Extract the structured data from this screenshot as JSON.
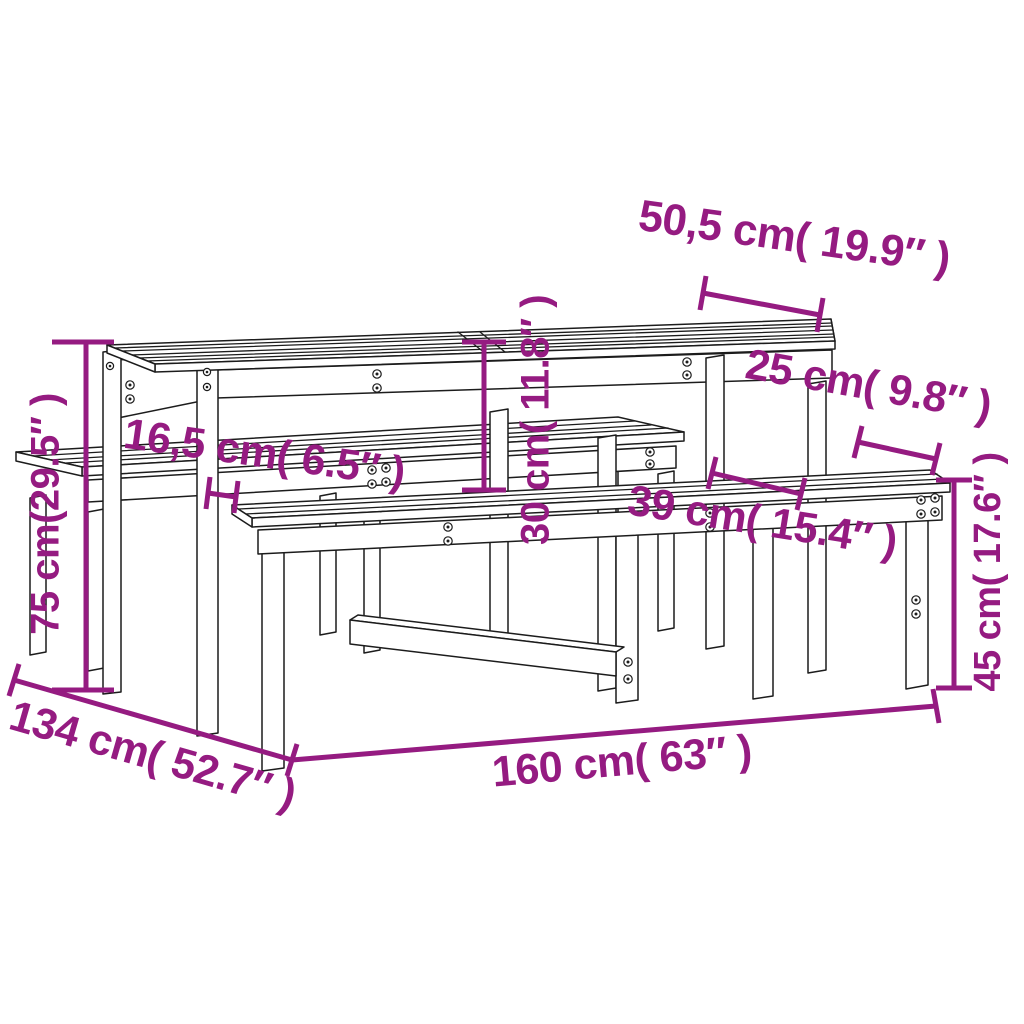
{
  "page": {
    "background": "#ffffff",
    "description": "Dimension diagram of a wooden picnic table with two benches"
  },
  "colors": {
    "dimension_accent": "#951b81",
    "drawing_line": "#1c1c1c"
  },
  "product": {
    "name": "picnic-table-with-benches"
  },
  "labels": {
    "table_top_depth": "50,5 cm( 19.9″ )",
    "bench_seat_depth": "25 cm( 9.8″ )",
    "table_bench_gap": "16,5 cm( 6.5″ )",
    "table_above_bench": "30 cm( 11.8″ )",
    "bench_total_depth": "39 cm( 15.4″ )",
    "table_height": "75 cm(29.5″ )",
    "bench_height": "45 cm( 17.6″ )",
    "total_depth": "134 cm( 52.7″ )",
    "total_length": "160 cm( 63″ )"
  }
}
